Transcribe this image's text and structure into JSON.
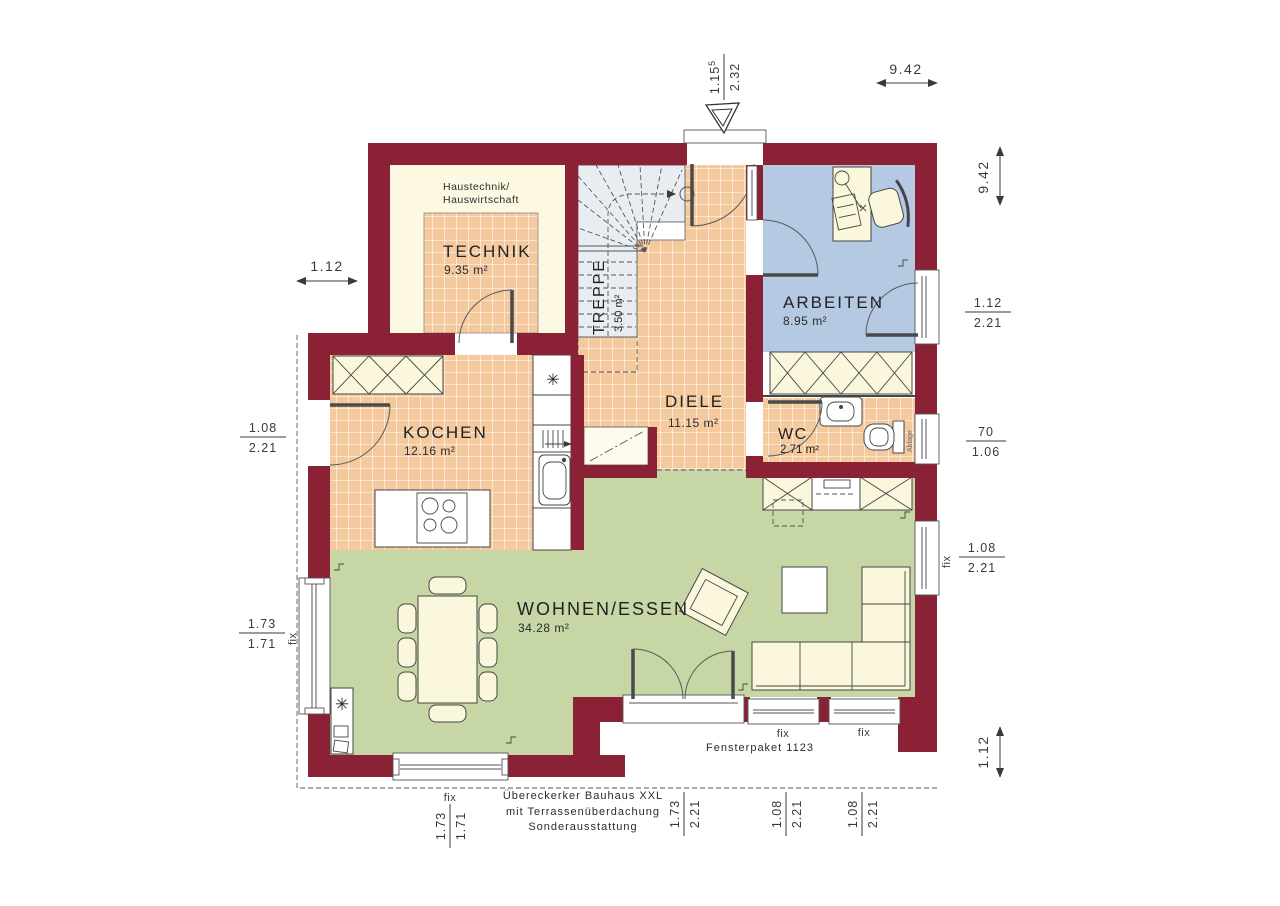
{
  "rooms": {
    "technik": {
      "name": "TECHNIK",
      "area": "9.35 m²",
      "note1": "Haustechnik/",
      "note2": "Hauswirtschaft"
    },
    "treppe": {
      "name": "TREPPE",
      "area": "3.50 m²"
    },
    "diele": {
      "name": "DIELE",
      "area": "11.15 m²"
    },
    "arbeiten": {
      "name": "ARBEITEN",
      "area": "8.95 m²"
    },
    "kochen": {
      "name": "KOCHEN",
      "area": "12.16 m²"
    },
    "wc": {
      "name": "WC",
      "area": "2.71 m²"
    },
    "wohnen": {
      "name": "WOHNEN/ESSEN",
      "area": "34.28 m²"
    }
  },
  "dimensions": {
    "top_width": "9.42",
    "right_height": "9.42",
    "entrance": {
      "num": "1.15",
      "sup": "5",
      "den": "2.32"
    },
    "left_upper": "1.12",
    "left_door": {
      "num": "1.08",
      "den": "2.21"
    },
    "left_window": {
      "prefix": "fix",
      "num": "1.73",
      "den": "1.71"
    },
    "right_door": {
      "num": "1.12",
      "den": "2.21"
    },
    "right_wc": {
      "num": "70",
      "den": "1.06"
    },
    "right_window": {
      "prefix": "fix",
      "num": "1.08",
      "den": "2.21"
    },
    "right_bottom": "1.12",
    "bottom_window_left": {
      "prefix": "fix",
      "num": "1.73",
      "den": "1.71"
    },
    "bottom_door": {
      "num": "1.73",
      "den": "2.21"
    },
    "bottom_window_mid": {
      "prefix": "fix",
      "num": "1.08",
      "den": "2.21"
    },
    "bottom_window_right": {
      "prefix": "fix",
      "num": "1.08",
      "den": "2.21"
    }
  },
  "annotations": {
    "fensterpaket": "Fensterpaket 1123",
    "footer1": "Übereckerker Bauhaus XXL",
    "footer2": "mit Terrassenüberdachung",
    "footer3": "Sonderausstattung",
    "ablage": "Ablage",
    "fix": "fix"
  },
  "colors": {
    "wall": "#8b2134",
    "tile": "#f4c99e",
    "work": "#b5c9e3",
    "living": "#c6d6a4",
    "cream": "#fcf8e2",
    "stair": "#e9edf1"
  }
}
